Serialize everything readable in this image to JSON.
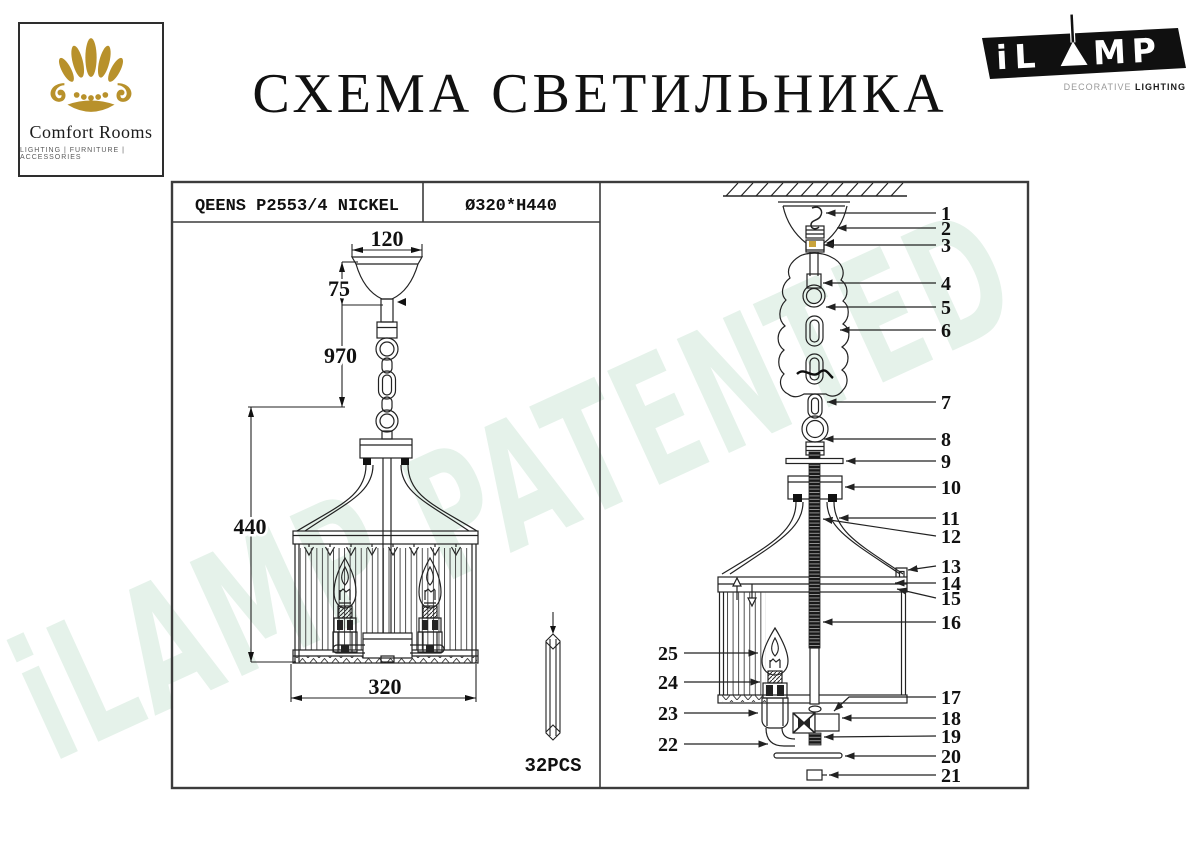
{
  "brand": {
    "name": "Comfort Rooms",
    "tagline": "LIGHTING  |  FURNITURE  |  ACCESSORIES"
  },
  "title": "СХЕМА СВЕТИЛЬНИКА",
  "ilamp": {
    "word_left": "iL",
    "word_right": "MP",
    "tag_light": "DECORATIVE ",
    "tag_bold": "LIGHTING"
  },
  "spec": {
    "model": "QEENS P2553/4 NICKEL",
    "size": "Ø320*H440"
  },
  "dims": {
    "canopy_width": "120",
    "canopy_height": "75",
    "suspension_length": "970",
    "body_height": "440",
    "body_diameter": "320"
  },
  "crystals": {
    "count_label": "32PCS"
  },
  "watermark": "iLAMP PATENTED",
  "parts": [
    "1",
    "2",
    "3",
    "4",
    "5",
    "6",
    "7",
    "8",
    "9",
    "10",
    "11",
    "12",
    "13",
    "14",
    "15",
    "16",
    "17",
    "18",
    "19",
    "20",
    "21",
    "22",
    "23",
    "24",
    "25"
  ],
  "colors": {
    "gold": "#b8912b",
    "line": "#222222",
    "watermark_green": "#e5f2ea"
  }
}
